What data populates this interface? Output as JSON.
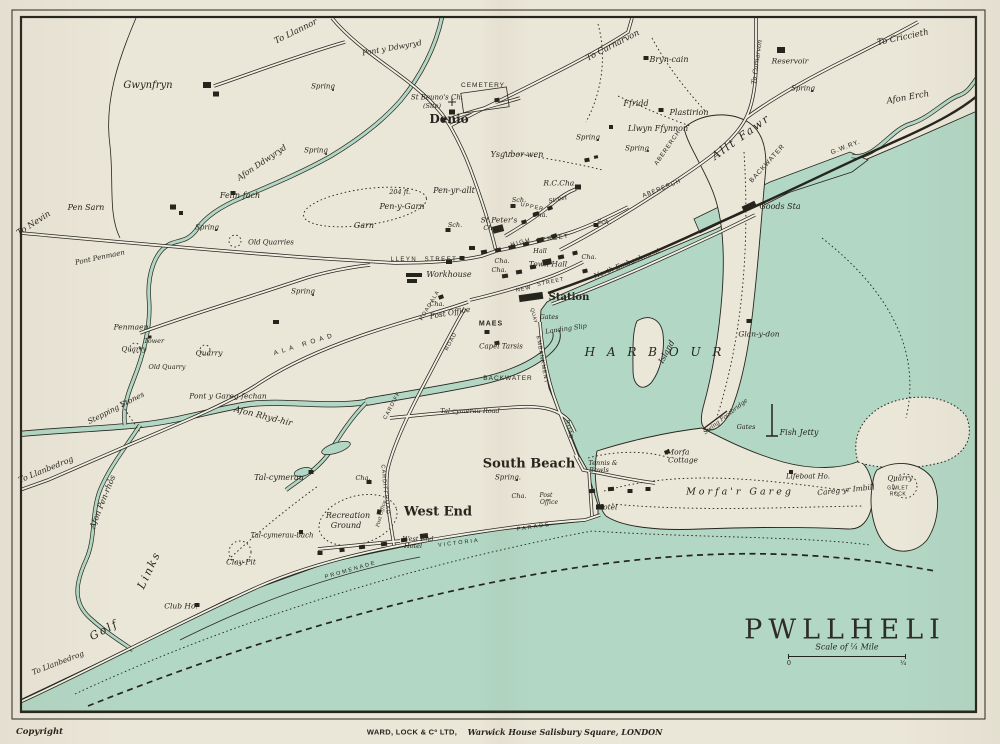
{
  "map": {
    "title": "PWLLHELI",
    "scale_label": "Scale of ¼ Mile",
    "scale_start": "0",
    "scale_end": "¼"
  },
  "imprint": {
    "copyright": "Copyright",
    "publisher": "WARD, LOCK & Cº LTD,",
    "address": "Warwick House Salisbury Square, LONDON"
  },
  "colors": {
    "paper": "#eae6d8",
    "water": "#b2d7c4",
    "ink": "#26251d"
  },
  "labels": [
    {
      "t": "Gwynfryn",
      "x": 148,
      "y": 86,
      "fs": 10,
      "st": "p"
    },
    {
      "t": "To Llannor",
      "x": 296,
      "y": 32,
      "fs": 8.5,
      "rot": -26,
      "st": "p"
    },
    {
      "t": "Pont y Ddwyryd",
      "x": 392,
      "y": 48,
      "fs": 7.5,
      "rot": -10,
      "st": "p"
    },
    {
      "t": "Spring",
      "x": 323,
      "y": 87,
      "fs": 7,
      "st": "p"
    },
    {
      "t": "Spring",
      "x": 316,
      "y": 151,
      "fs": 7,
      "st": "p"
    },
    {
      "t": "Afon Ddwyryd",
      "x": 262,
      "y": 163,
      "fs": 8,
      "rot": -34,
      "st": "p"
    },
    {
      "t": "Felin-fach",
      "x": 240,
      "y": 196,
      "fs": 8,
      "st": "p"
    },
    {
      "t": "Pen Sarn",
      "x": 86,
      "y": 208,
      "fs": 8,
      "st": "p"
    },
    {
      "t": "To Nevin",
      "x": 34,
      "y": 224,
      "fs": 8.5,
      "rot": -33,
      "st": "p"
    },
    {
      "t": "Spring",
      "x": 207,
      "y": 228,
      "fs": 7,
      "st": "p"
    },
    {
      "t": "Old Quarries",
      "x": 271,
      "y": 243,
      "fs": 7,
      "st": "p"
    },
    {
      "t": "Spring",
      "x": 303,
      "y": 292,
      "fs": 7,
      "st": "p"
    },
    {
      "t": "St Beuno's Ch.",
      "x": 437,
      "y": 98,
      "fs": 7,
      "st": "p"
    },
    {
      "t": "(Site)",
      "x": 432,
      "y": 106,
      "fs": 6.5,
      "st": "p"
    },
    {
      "t": "CEMETERY",
      "x": 483,
      "y": 86,
      "fs": 6.5,
      "st": "s",
      "ls": 1
    },
    {
      "t": "Denio",
      "x": 449,
      "y": 119,
      "fs": 12,
      "st": "big",
      "n": "district-label-denio"
    },
    {
      "t": "To Carnarvon",
      "x": 613,
      "y": 46,
      "fs": 8.5,
      "rot": -27,
      "st": "p"
    },
    {
      "t": "Bryn-cain",
      "x": 669,
      "y": 60,
      "fs": 8,
      "st": "p"
    },
    {
      "t": "Ffridd",
      "x": 636,
      "y": 104,
      "fs": 8,
      "st": "p"
    },
    {
      "t": "Plastirion",
      "x": 689,
      "y": 113,
      "fs": 8,
      "st": "p"
    },
    {
      "t": "Reservoir",
      "x": 790,
      "y": 61,
      "fs": 7.5,
      "st": "p"
    },
    {
      "t": "Spring",
      "x": 803,
      "y": 89,
      "fs": 7,
      "st": "p"
    },
    {
      "t": "To Criccieth",
      "x": 903,
      "y": 38,
      "fs": 8.5,
      "rot": -12,
      "st": "p"
    },
    {
      "t": "To Carnarvon",
      "x": 757,
      "y": 62,
      "fs": 6.5,
      "rot": -82,
      "st": "p"
    },
    {
      "t": "Afon Erch",
      "x": 908,
      "y": 98,
      "fs": 8.5,
      "rot": -10,
      "st": "p"
    },
    {
      "t": "Llwyn Ffynnon",
      "x": 658,
      "y": 129,
      "fs": 8,
      "st": "p"
    },
    {
      "t": "Spring",
      "x": 637,
      "y": 149,
      "fs": 7,
      "st": "p"
    },
    {
      "t": "Allt Fawr",
      "x": 741,
      "y": 137,
      "fs": 11,
      "rot": -36,
      "st": "p",
      "ls": 2
    },
    {
      "t": "ABERERCH",
      "x": 668,
      "y": 148,
      "fs": 6,
      "rot": -55,
      "st": "s",
      "ls": 1
    },
    {
      "t": "ABERERCH",
      "x": 662,
      "y": 189,
      "fs": 6,
      "rot": -22,
      "st": "s",
      "ls": 1
    },
    {
      "t": "BACKWATER",
      "x": 768,
      "y": 164,
      "fs": 6.5,
      "rot": -48,
      "st": "s",
      "ls": 1
    },
    {
      "t": "G.W.RY.",
      "x": 846,
      "y": 148,
      "fs": 6.5,
      "rot": -21,
      "st": "s",
      "ls": 1
    },
    {
      "t": "Goods Sta",
      "x": 780,
      "y": 207,
      "fs": 8,
      "st": "p"
    },
    {
      "t": "Ysgubor-wen",
      "x": 517,
      "y": 155,
      "fs": 8,
      "st": "p"
    },
    {
      "t": "Spring",
      "x": 588,
      "y": 138,
      "fs": 7,
      "st": "p"
    },
    {
      "t": "R.C.Cha.",
      "x": 560,
      "y": 183,
      "fs": 7.5,
      "st": "p"
    },
    {
      "t": "204 ft.",
      "x": 400,
      "y": 192,
      "fs": 6.5,
      "st": "p"
    },
    {
      "t": "Pen-y-Garn",
      "x": 402,
      "y": 207,
      "fs": 8,
      "st": "p"
    },
    {
      "t": "Pen-yr-allt",
      "x": 454,
      "y": 191,
      "fs": 8,
      "st": "p"
    },
    {
      "t": "Garn",
      "x": 364,
      "y": 226,
      "fs": 8,
      "st": "p"
    },
    {
      "t": "Sch.",
      "x": 519,
      "y": 200,
      "fs": 6.5,
      "st": "p"
    },
    {
      "t": "Sch.",
      "x": 455,
      "y": 225,
      "fs": 6.5,
      "st": "p"
    },
    {
      "t": "Sch.",
      "x": 604,
      "y": 222,
      "fs": 6.5,
      "st": "p"
    },
    {
      "t": "St Peter's",
      "x": 499,
      "y": 220,
      "fs": 7.5,
      "st": "p"
    },
    {
      "t": "Ch.",
      "x": 489,
      "y": 228,
      "fs": 6.5,
      "st": "p"
    },
    {
      "t": "UPPER",
      "x": 532,
      "y": 208,
      "fs": 5.5,
      "rot": 12,
      "st": "s",
      "ls": 1
    },
    {
      "t": "Street",
      "x": 558,
      "y": 200,
      "fs": 6,
      "rot": -12,
      "st": "p"
    },
    {
      "t": "Cha.",
      "x": 540,
      "y": 215,
      "fs": 6.5,
      "st": "p"
    },
    {
      "t": "HIGH",
      "x": 521,
      "y": 243,
      "fs": 6,
      "rot": -15,
      "st": "s",
      "ls": 1.5
    },
    {
      "t": "STREET",
      "x": 553,
      "y": 239,
      "fs": 6,
      "rot": -8,
      "st": "s",
      "ls": 1.5
    },
    {
      "t": "Hall",
      "x": 540,
      "y": 251,
      "fs": 6.5,
      "st": "p"
    },
    {
      "t": "Town Hall",
      "x": 548,
      "y": 264,
      "fs": 7.5,
      "st": "p"
    },
    {
      "t": "Cha.",
      "x": 589,
      "y": 257,
      "fs": 6.5,
      "st": "p"
    },
    {
      "t": "Cha.",
      "x": 502,
      "y": 261,
      "fs": 6.5,
      "st": "p"
    },
    {
      "t": "Cha.",
      "x": 499,
      "y": 270,
      "fs": 6.5,
      "st": "p"
    },
    {
      "t": "LLEYN",
      "x": 404,
      "y": 260,
      "fs": 6,
      "st": "s",
      "ls": 1.5
    },
    {
      "t": "STREET",
      "x": 441,
      "y": 260,
      "fs": 6,
      "st": "s",
      "ls": 1.5
    },
    {
      "t": "Workhouse",
      "x": 449,
      "y": 275,
      "fs": 8,
      "st": "p"
    },
    {
      "t": "NEW",
      "x": 524,
      "y": 290,
      "fs": 5.5,
      "rot": -12,
      "st": "s",
      "ls": 1
    },
    {
      "t": "STREET",
      "x": 551,
      "y": 283,
      "fs": 5.5,
      "rot": -12,
      "st": "s",
      "ls": 1
    },
    {
      "t": "ALA",
      "x": 436,
      "y": 297,
      "fs": 5.5,
      "rot": -60,
      "st": "s",
      "ls": 1
    },
    {
      "t": "ROAD",
      "x": 427,
      "y": 312,
      "fs": 5.5,
      "rot": -60,
      "st": "s",
      "ls": 1
    },
    {
      "t": "ALA  ROAD",
      "x": 305,
      "y": 345,
      "fs": 6.5,
      "rot": -17,
      "st": "s",
      "ls": 4
    },
    {
      "t": "MAES",
      "x": 491,
      "y": 324,
      "fs": 7,
      "st": "s",
      "ls": 1,
      "b": 1
    },
    {
      "t": "Cha.",
      "x": 437,
      "y": 304,
      "fs": 6.5,
      "st": "p"
    },
    {
      "t": "Post Office",
      "x": 450,
      "y": 313,
      "fs": 7.5,
      "rot": -10,
      "st": "p"
    },
    {
      "t": "Capel Tarsis",
      "x": 501,
      "y": 347,
      "fs": 7,
      "st": "p"
    },
    {
      "t": "BACKWATER",
      "x": 508,
      "y": 379,
      "fs": 6.5,
      "st": "s",
      "ls": 1
    },
    {
      "t": "EMBANKMENT",
      "x": 541,
      "y": 360,
      "fs": 5.5,
      "rot": 80,
      "st": "s",
      "ls": 1
    },
    {
      "t": "Station",
      "x": 569,
      "y": 298,
      "fs": 10,
      "st": "big",
      "n": "station-label"
    },
    {
      "t": "QUAY",
      "x": 533,
      "y": 316,
      "fs": 5,
      "rot": 75,
      "st": "s",
      "ls": 0.5
    },
    {
      "t": "Gates",
      "x": 549,
      "y": 317,
      "fs": 6.5,
      "st": "p"
    },
    {
      "t": "Landing Slip",
      "x": 566,
      "y": 329,
      "fs": 6.5,
      "rot": -8,
      "st": "p"
    },
    {
      "t": "North Embankment",
      "x": 627,
      "y": 264,
      "fs": 7,
      "rot": -22,
      "st": "p"
    },
    {
      "t": "H A R B O U R",
      "x": 655,
      "y": 352,
      "fs": 12,
      "st": "p",
      "ls": 4,
      "n": "harbour-label"
    },
    {
      "t": "Island",
      "x": 667,
      "y": 352,
      "fs": 8,
      "rot": -62,
      "st": "p"
    },
    {
      "t": "Glan-y-don",
      "x": 759,
      "y": 334,
      "fs": 7.5,
      "st": "p"
    },
    {
      "t": "Swing Footbridge",
      "x": 726,
      "y": 417,
      "fs": 6,
      "rot": -38,
      "st": "p"
    },
    {
      "t": "Gates",
      "x": 746,
      "y": 427,
      "fs": 6.5,
      "st": "p"
    },
    {
      "t": "Fish Jetty",
      "x": 799,
      "y": 433,
      "fs": 8,
      "st": "p"
    },
    {
      "t": "Morfa",
      "x": 678,
      "y": 452,
      "fs": 7.5,
      "st": "p"
    },
    {
      "t": "Cottage",
      "x": 683,
      "y": 460,
      "fs": 7.5,
      "st": "p"
    },
    {
      "t": "Tennis &",
      "x": 603,
      "y": 463,
      "fs": 6.5,
      "st": "p"
    },
    {
      "t": "Bowls",
      "x": 599,
      "y": 470,
      "fs": 6.5,
      "st": "p"
    },
    {
      "t": "Lifeboat Ho.",
      "x": 808,
      "y": 477,
      "fs": 7,
      "st": "p"
    },
    {
      "t": "Morfa'r  Gareg",
      "x": 740,
      "y": 492,
      "fs": 9.5,
      "st": "p",
      "ls": 3
    },
    {
      "t": "Careg yr Imbill",
      "x": 846,
      "y": 490,
      "fs": 7.5,
      "rot": -6,
      "st": "p"
    },
    {
      "t": "Quarry",
      "x": 900,
      "y": 479,
      "fs": 7,
      "st": "p"
    },
    {
      "t": "GIMLET",
      "x": 898,
      "y": 489,
      "fs": 5,
      "st": "s",
      "ls": 0.5
    },
    {
      "t": "ROCK",
      "x": 898,
      "y": 495,
      "fs": 5,
      "st": "s",
      "ls": 0.5
    },
    {
      "t": "Hotel",
      "x": 607,
      "y": 507,
      "fs": 7.5,
      "st": "p"
    },
    {
      "t": "South Beach",
      "x": 529,
      "y": 464,
      "fs": 13,
      "st": "big",
      "n": "district-label-south-beach"
    },
    {
      "t": "Spring.",
      "x": 508,
      "y": 478,
      "fs": 7,
      "st": "p"
    },
    {
      "t": "Cha.",
      "x": 519,
      "y": 496,
      "fs": 6.5,
      "st": "p"
    },
    {
      "t": "Post",
      "x": 546,
      "y": 496,
      "fs": 6,
      "st": "p"
    },
    {
      "t": "Office",
      "x": 549,
      "y": 503,
      "fs": 6,
      "st": "p"
    },
    {
      "t": "ROAD",
      "x": 568,
      "y": 430,
      "fs": 5.5,
      "rot": 78,
      "st": "s",
      "ls": 1
    },
    {
      "t": "Tal-cymerau  Road",
      "x": 470,
      "y": 411,
      "fs": 6.5,
      "st": "p"
    },
    {
      "t": "West End",
      "x": 438,
      "y": 512,
      "fs": 13,
      "st": "big",
      "n": "district-label-west-end"
    },
    {
      "t": "Cha.",
      "x": 363,
      "y": 478,
      "fs": 6.5,
      "st": "p"
    },
    {
      "t": "Recreation",
      "x": 348,
      "y": 516,
      "fs": 8,
      "st": "p"
    },
    {
      "t": "Ground",
      "x": 346,
      "y": 526,
      "fs": 8,
      "st": "p"
    },
    {
      "t": "Post Office",
      "x": 382,
      "y": 514,
      "fs": 5,
      "rot": -75,
      "st": "p"
    },
    {
      "t": "West End",
      "x": 418,
      "y": 539,
      "fs": 6.5,
      "st": "p"
    },
    {
      "t": "Hotel",
      "x": 413,
      "y": 546,
      "fs": 6.5,
      "st": "p"
    },
    {
      "t": "VICTORIA",
      "x": 459,
      "y": 544,
      "fs": 5.5,
      "rot": -7,
      "st": "s",
      "ls": 2
    },
    {
      "t": "PARADE",
      "x": 534,
      "y": 528,
      "fs": 5.5,
      "rot": -9,
      "st": "s",
      "ls": 2
    },
    {
      "t": "PROMENADE",
      "x": 351,
      "y": 571,
      "fs": 5.5,
      "rot": -16,
      "st": "s",
      "ls": 2
    },
    {
      "t": "CARDIFF",
      "x": 393,
      "y": 406,
      "fs": 5.5,
      "rot": -62,
      "st": "s",
      "ls": 1
    },
    {
      "t": "ROAD",
      "x": 452,
      "y": 342,
      "fs": 5.5,
      "rot": -62,
      "st": "s",
      "ls": 1
    },
    {
      "t": "CARDIFF",
      "x": 383,
      "y": 480,
      "fs": 5.5,
      "rot": 85,
      "st": "s",
      "ls": 1
    },
    {
      "t": "ROAD",
      "x": 386,
      "y": 505,
      "fs": 5.5,
      "rot": 85,
      "st": "s",
      "ls": 1
    },
    {
      "t": "To Llanbedrog",
      "x": 46,
      "y": 470,
      "fs": 8,
      "rot": -22,
      "st": "p"
    },
    {
      "t": "Stepping Stones",
      "x": 116,
      "y": 408,
      "fs": 7.5,
      "rot": -27,
      "st": "p"
    },
    {
      "t": "Afon  Rhyd-hir",
      "x": 263,
      "y": 417,
      "fs": 8.5,
      "rot": 14,
      "st": "p"
    },
    {
      "t": "Afon Pen-rhôs",
      "x": 103,
      "y": 502,
      "fs": 8,
      "rot": -68,
      "st": "p"
    },
    {
      "t": "Golf",
      "x": 104,
      "y": 630,
      "fs": 11,
      "rot": -28,
      "st": "p",
      "ls": 2
    },
    {
      "t": "Links",
      "x": 149,
      "y": 570,
      "fs": 11,
      "rot": -65,
      "st": "p",
      "ls": 2
    },
    {
      "t": "Club Ho.",
      "x": 181,
      "y": 606,
      "fs": 7.5,
      "st": "p"
    },
    {
      "t": "Clay Pit",
      "x": 241,
      "y": 562,
      "fs": 7.5,
      "st": "p"
    },
    {
      "t": "Tal-cymerau",
      "x": 279,
      "y": 478,
      "fs": 8,
      "st": "p"
    },
    {
      "t": "Tal-cymerau-bach",
      "x": 282,
      "y": 536,
      "fs": 7,
      "st": "p"
    },
    {
      "t": "To Llanbedrog",
      "x": 58,
      "y": 663,
      "fs": 7.5,
      "rot": -21,
      "st": "p"
    },
    {
      "t": "Pont Penmaen",
      "x": 100,
      "y": 258,
      "fs": 7,
      "rot": -12,
      "st": "p"
    },
    {
      "t": "Penmaen",
      "x": 131,
      "y": 327,
      "fs": 7.5,
      "st": "p"
    },
    {
      "t": "Tower",
      "x": 154,
      "y": 341,
      "fs": 6.5,
      "st": "p"
    },
    {
      "t": "Quarry",
      "x": 134,
      "y": 350,
      "fs": 7,
      "st": "p"
    },
    {
      "t": "Quarry",
      "x": 209,
      "y": 353,
      "fs": 7.5,
      "st": "p"
    },
    {
      "t": "Old Quarry",
      "x": 167,
      "y": 367,
      "fs": 6.5,
      "st": "p"
    },
    {
      "t": "Pont y Gareg-fechan",
      "x": 228,
      "y": 396,
      "fs": 7.5,
      "st": "p"
    }
  ]
}
